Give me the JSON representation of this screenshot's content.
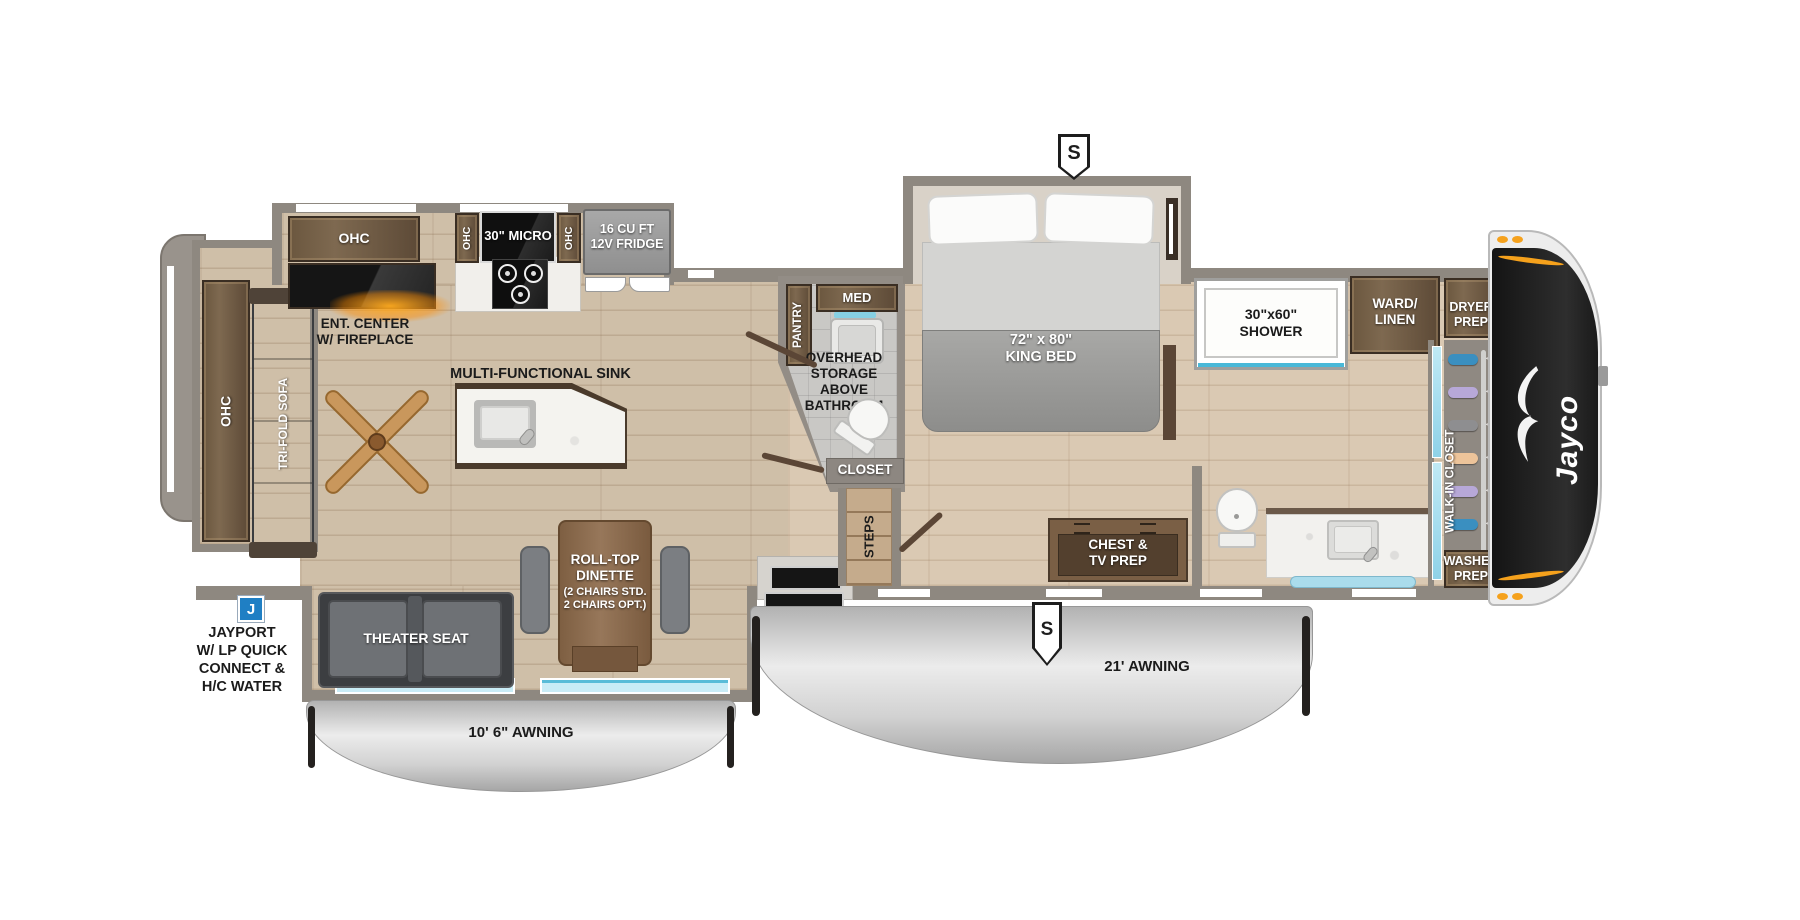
{
  "badges": {
    "street_side_top": "S",
    "street_side_bottom": "S",
    "jayport": "J"
  },
  "front_cap": {
    "brand": "Jayco"
  },
  "kitchen": {
    "ohc": "OHC",
    "ent_center": "ENT. CENTER\nW/ FIREPLACE",
    "ohc_left": "OHC",
    "microwave": "30\" MICRO",
    "ohc_right": "OHC",
    "fridge": "16 CU FT\n12V FRIDGE",
    "island_label": "MULTI-FUNCTIONAL SINK"
  },
  "living": {
    "rear_ohc": "OHC",
    "sofa": "TRI-FOLD SOFA",
    "theater_seat": "THEATER SEAT",
    "dinette_title": "ROLL-TOP\nDINETTE",
    "dinette_sub": "(2 CHAIRS STD.\n2 CHAIRS OPT.)"
  },
  "mid_bath": {
    "pantry": "PANTRY",
    "med_cabinet": "MED",
    "overhead_storage": "OVERHEAD\nSTORAGE\nABOVE\nBATHROOM",
    "closet": "CLOSET",
    "steps": "STEPS"
  },
  "bedroom": {
    "king_bed": "72\" x 80\"\nKING BED",
    "chest": "CHEST &\nTV PREP"
  },
  "rear_bath": {
    "shower": "30\"x60\"\nSHOWER",
    "ward_linen": "WARD/\nLINEN"
  },
  "walk_in": {
    "dryer_prep": "DRYER\nPREP",
    "label": "WALK-IN CLOSET",
    "washer_prep": "WASHER\nPREP",
    "clothes_colors": [
      "#3a8fc0",
      "#b7a8d8",
      "#8e8e90",
      "#edc49a",
      "#b7a8d8",
      "#3a8fc0",
      "#e8c94f"
    ]
  },
  "exterior": {
    "awning_front": "21' AWNING",
    "awning_rear": "10' 6\" AWNING",
    "jayport_label": "JAYPORT\nW/ LP QUICK\nCONNECT &\nH/C WATER"
  },
  "colors": {
    "accent_orange": "#f5a11c",
    "jayport_blue": "#1f7fc4",
    "cap_black": "#141414",
    "awning_silver": "#d9d9d9"
  }
}
